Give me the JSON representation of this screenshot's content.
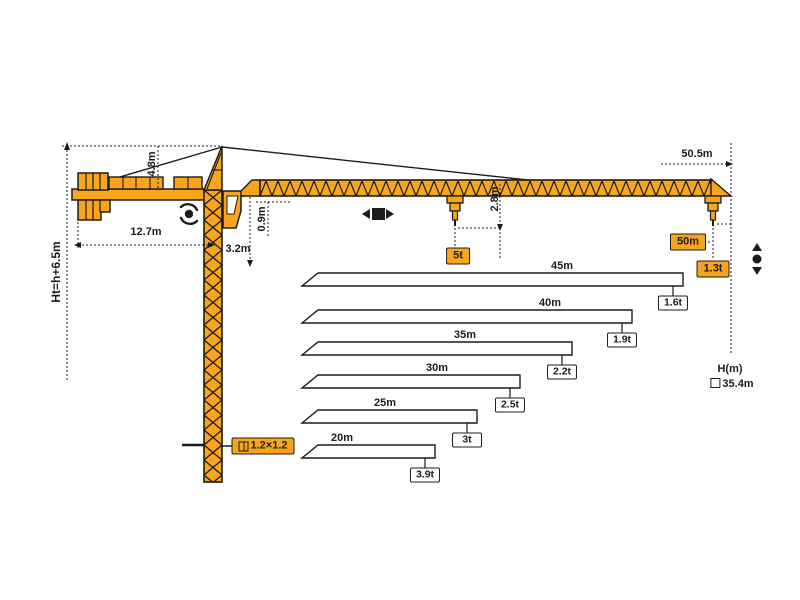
{
  "colors": {
    "crane_yellow": "#F7A51D",
    "outline": "#1C1C1C",
    "bar_fill": "#FFFFFF"
  },
  "dimensions": {
    "total_height": "Ht=h+6.5m",
    "tower_head_height": "4.8m",
    "counter_jib_length": "12.7m",
    "cab_section_height": "3.2m",
    "jib_depth": "0.9m",
    "hook_clearance": "2.8m",
    "max_radius": "50.5m",
    "height_axis_label": "H(m)",
    "freestanding_height": "35.4m",
    "mast_section": "1.2×1.2"
  },
  "load_points": {
    "trolley_capacity": "5t",
    "tip_radius": "50m",
    "tip_capacity": "1.3t"
  },
  "icons": {
    "slewing": "slewing-rotation-icon",
    "trolley": "trolley-travel-icon",
    "hoist": "hoist-up-down-icon",
    "mast_section": "square-section-icon",
    "height_marker": "square-marker-icon"
  },
  "chart_data": {
    "type": "bar",
    "orientation": "horizontal",
    "description": "Jib length vs tip load capacity",
    "categories": [
      "45m",
      "40m",
      "35m",
      "30m",
      "25m",
      "20m"
    ],
    "values_t": [
      1.6,
      1.9,
      2.2,
      2.5,
      3.0,
      3.9
    ],
    "bars": [
      {
        "length_m": 45,
        "length_label": "45m",
        "capacity_t": 1.6,
        "capacity_label": "1.6t"
      },
      {
        "length_m": 40,
        "length_label": "40m",
        "capacity_t": 1.9,
        "capacity_label": "1.9t"
      },
      {
        "length_m": 35,
        "length_label": "35m",
        "capacity_t": 2.2,
        "capacity_label": "2.2t"
      },
      {
        "length_m": 30,
        "length_label": "30m",
        "capacity_t": 2.5,
        "capacity_label": "2.5t"
      },
      {
        "length_m": 25,
        "length_label": "25m",
        "capacity_t": 3.0,
        "capacity_label": "3t"
      },
      {
        "length_m": 20,
        "length_label": "20m",
        "capacity_t": 3.9,
        "capacity_label": "3.9t"
      }
    ],
    "layout": {
      "left_x": 302,
      "slant_px": 16,
      "bar_height": 13,
      "tops": [
        273,
        310,
        342,
        375,
        410,
        445
      ],
      "right_xs": [
        683,
        632,
        572,
        520,
        477,
        435
      ],
      "label_xs": [
        562,
        550,
        465,
        437,
        385,
        342
      ]
    }
  }
}
